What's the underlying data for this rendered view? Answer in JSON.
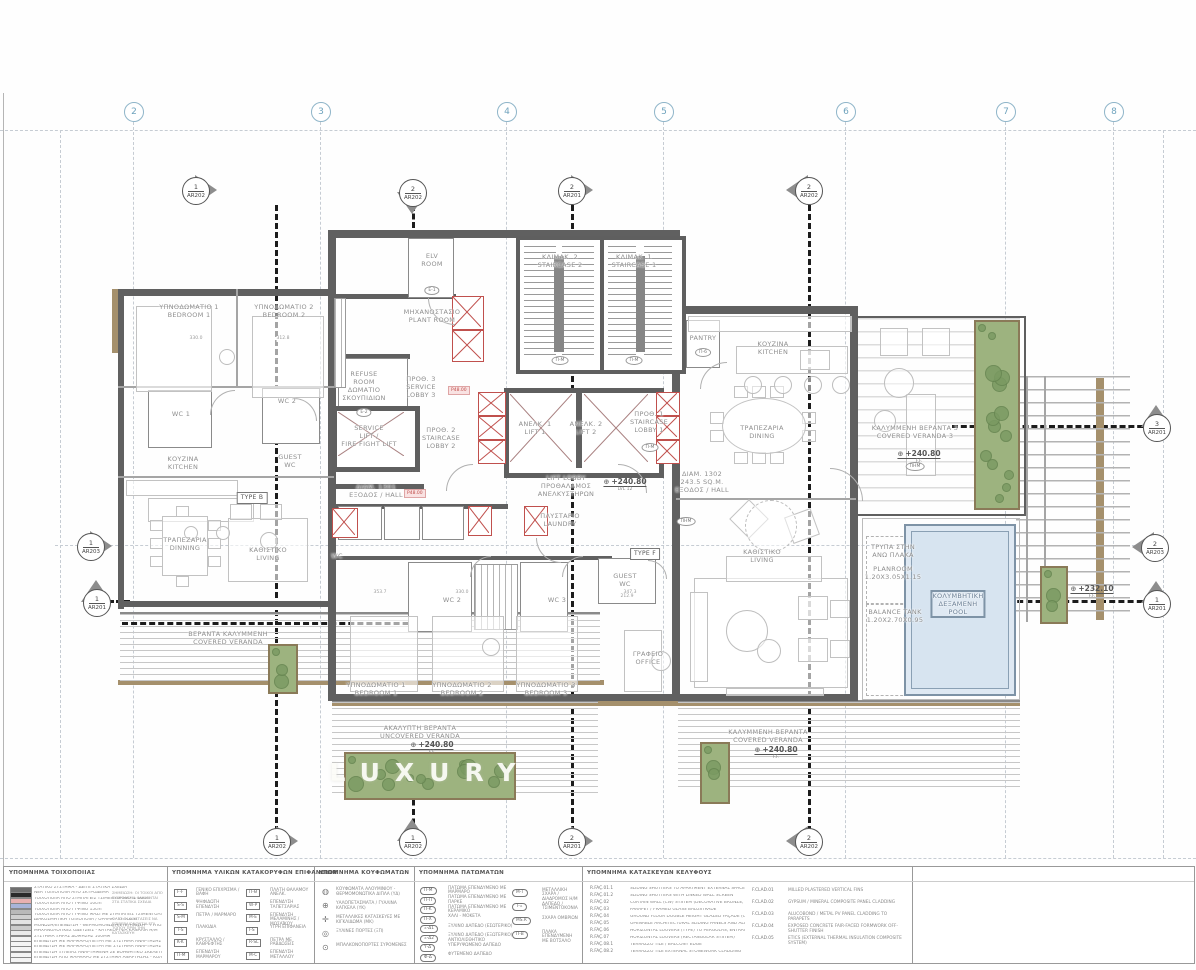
{
  "watermark": {
    "text": "LUXURY"
  },
  "grid": {
    "columns": [
      {
        "label": "2",
        "x": 133
      },
      {
        "label": "3",
        "x": 320
      },
      {
        "label": "4",
        "x": 506
      },
      {
        "label": "5",
        "x": 663
      },
      {
        "label": "6",
        "x": 845
      },
      {
        "label": "7",
        "x": 1005
      },
      {
        "label": "8",
        "x": 1113
      }
    ]
  },
  "section_markers": [
    {
      "num": "1",
      "sheet": "AR202",
      "x": 195,
      "y": 190,
      "dir": "right"
    },
    {
      "num": "2",
      "sheet": "AR202",
      "x": 412,
      "y": 192,
      "dir": "down"
    },
    {
      "num": "2",
      "sheet": "AR201",
      "x": 571,
      "y": 190,
      "dir": "right"
    },
    {
      "num": "2",
      "sheet": "AR202",
      "x": 808,
      "y": 190,
      "dir": "left"
    },
    {
      "num": "1",
      "sheet": "AR203",
      "x": 90,
      "y": 546,
      "dir": "right"
    },
    {
      "num": "1",
      "sheet": "AR201",
      "x": 96,
      "y": 602,
      "dir": "up"
    },
    {
      "num": "3",
      "sheet": "AR201",
      "x": 1156,
      "y": 427,
      "dir": "up"
    },
    {
      "num": "2",
      "sheet": "AR203",
      "x": 1154,
      "y": 547,
      "dir": "left"
    },
    {
      "num": "1",
      "sheet": "AR201",
      "x": 1156,
      "y": 603,
      "dir": "up"
    },
    {
      "num": "1",
      "sheet": "AR202",
      "x": 276,
      "y": 841,
      "dir": "right"
    },
    {
      "num": "1",
      "sheet": "AR202",
      "x": 412,
      "y": 841,
      "dir": "up"
    },
    {
      "num": "2",
      "sheet": "AR201",
      "x": 571,
      "y": 841,
      "dir": "right"
    },
    {
      "num": "2",
      "sheet": "AR202",
      "x": 808,
      "y": 841,
      "dir": "left"
    }
  ],
  "room_labels": [
    {
      "x": 189,
      "y": 303,
      "lines": [
        "ΥΠΝΟΔΩΜΑΤΙΟ 1",
        "BEDROOM 1"
      ]
    },
    {
      "x": 284,
      "y": 303,
      "lines": [
        "ΥΠΝΟΔΩΜΑΤΙΟ 2",
        "BEDROOM 2"
      ]
    },
    {
      "x": 181,
      "y": 410,
      "lines": [
        "WC 1"
      ]
    },
    {
      "x": 287,
      "y": 397,
      "lines": [
        "WC 2"
      ]
    },
    {
      "x": 183,
      "y": 455,
      "lines": [
        "ΚΟΥΖΙΝΑ",
        "KITCHEN"
      ]
    },
    {
      "x": 290,
      "y": 453,
      "lines": [
        "GUEST",
        "WC"
      ]
    },
    {
      "x": 185,
      "y": 536,
      "lines": [
        "ΤΡΑΠΕΖΑΡΙΑ",
        "DINNING"
      ]
    },
    {
      "x": 268,
      "y": 546,
      "lines": [
        "ΚΑΘΙΣΤΙΚΟ",
        "LIVING"
      ]
    },
    {
      "x": 252,
      "y": 492,
      "lines": [
        "TYPE B"
      ],
      "cls": "boxed"
    },
    {
      "x": 432,
      "y": 308,
      "lines": [
        "ΜΗΧΑΝΟΣΤΑΣΙΟ",
        "PLANT ROOM"
      ]
    },
    {
      "x": 432,
      "y": 252,
      "lines": [
        "ELV",
        "ROOM"
      ]
    },
    {
      "x": 364,
      "y": 370,
      "lines": [
        "REFUSE",
        "ROOM",
        "ΔΩΜΑΤΙΟ",
        "ΣΚΟΥΠΙΔΙΩΝ"
      ]
    },
    {
      "x": 421,
      "y": 375,
      "lines": [
        "ΠΡΟΘ. 3",
        "SERVICE",
        "LOBBY 3"
      ]
    },
    {
      "x": 369,
      "y": 424,
      "lines": [
        "SERVICE",
        "LIFT /",
        "FIRE FIGHT LIFT"
      ]
    },
    {
      "x": 441,
      "y": 426,
      "lines": [
        "ΠΡΟΘ. 2",
        "STAIRCASE",
        "LOBBY 2"
      ]
    },
    {
      "x": 535,
      "y": 420,
      "lines": [
        "ΑΝΕΛΚ. 1",
        "LIFT 1"
      ]
    },
    {
      "x": 586,
      "y": 420,
      "lines": [
        "ΑΝΕΛΚ. 2",
        "LIFT 2"
      ]
    },
    {
      "x": 560,
      "y": 253,
      "lines": [
        "ΚΛΙΜΑΚ. 2",
        "STAIRCASE 2"
      ]
    },
    {
      "x": 634,
      "y": 253,
      "lines": [
        "ΚΛΙΜΑΚ. 1",
        "STAIRCASE 1"
      ]
    },
    {
      "x": 649,
      "y": 410,
      "lines": [
        "ΠΡΟΘ. 1",
        "STAIRCASE",
        "LOBBY 1"
      ]
    },
    {
      "x": 566,
      "y": 474,
      "lines": [
        "LIFT LOBBY",
        "ΠΡΟΘΑΛΑΜΟΣ",
        "ΑΝΕΛΚΥΣΤΗΡΩΝ"
      ]
    },
    {
      "x": 376,
      "y": 483,
      "lines": [
        "ΔΙΑΜ. 1301",
        "ΕΞΟΔΟΣ / HALL"
      ]
    },
    {
      "x": 702,
      "y": 470,
      "lines": [
        "ΔΙΑΜ. 1302",
        "243.5 SQ.M.",
        "ΕΞΟΔΟΣ / HALL"
      ]
    },
    {
      "x": 560,
      "y": 512,
      "lines": [
        "ΠΛΥΣΤΑΡΙΟ",
        "LAUNDRY"
      ]
    },
    {
      "x": 703,
      "y": 334,
      "lines": [
        "PANTRY"
      ]
    },
    {
      "x": 773,
      "y": 340,
      "lines": [
        "ΚΟΥΖΙΝΑ",
        "KITCHEN"
      ]
    },
    {
      "x": 762,
      "y": 424,
      "lines": [
        "ΤΡΑΠΕΖΑΡΙΑ",
        "DINING"
      ]
    },
    {
      "x": 915,
      "y": 424,
      "lines": [
        "ΚΑΛΥΜΜΕΝΗ ΒΕΡΑΝΤΑ 3",
        "COVERED VERANDA 3"
      ]
    },
    {
      "x": 762,
      "y": 548,
      "lines": [
        "ΚΑΘΙΣΤΙΚΟ",
        "LIVING"
      ]
    },
    {
      "x": 893,
      "y": 543,
      "lines": [
        "ΤΡΥΠΑ ΣΤΗΝ",
        "ΑΝΩ ΠΛΑΚΑ"
      ]
    },
    {
      "x": 893,
      "y": 565,
      "lines": [
        "PLANROOM",
        "1.20X3.05X1.15"
      ]
    },
    {
      "x": 895,
      "y": 608,
      "lines": [
        "BALANCE TANK",
        "1.20X2.70X0.95"
      ]
    },
    {
      "x": 958,
      "y": 590,
      "lines": [
        "ΚΟΛΥΜΒΗΤΙΚΗ",
        "ΔΕΞΑΜΕΝΗ",
        "POOL"
      ],
      "cls": "pool"
    },
    {
      "x": 337,
      "y": 552,
      "lines": [
        "WC"
      ]
    },
    {
      "x": 452,
      "y": 596,
      "lines": [
        "WC 2"
      ]
    },
    {
      "x": 557,
      "y": 596,
      "lines": [
        "WC 3"
      ]
    },
    {
      "x": 625,
      "y": 572,
      "lines": [
        "GUEST",
        "WC"
      ]
    },
    {
      "x": 648,
      "y": 650,
      "lines": [
        "ΓΡΑΦΕΙΟ",
        "OFFICE"
      ]
    },
    {
      "x": 645,
      "y": 548,
      "lines": [
        "TYPE F"
      ],
      "cls": "boxed"
    },
    {
      "x": 376,
      "y": 681,
      "lines": [
        "ΥΠΝΟΔΩΜΑΤΙΟ 1",
        "BEDROOM 1"
      ]
    },
    {
      "x": 462,
      "y": 681,
      "lines": [
        "ΥΠΝΟΔΩΜΑΤΙΟ 2",
        "BEDROOM 2"
      ]
    },
    {
      "x": 546,
      "y": 681,
      "lines": [
        "ΥΠΝΟΔΩΜΑΤΙΟ 3",
        "BEDROOM 3"
      ]
    },
    {
      "x": 228,
      "y": 630,
      "lines": [
        "ΒΕΡΑΝΤΑ ΚΑΛΥΜΜΕΝΗ",
        "COVERED VERANDA"
      ]
    },
    {
      "x": 420,
      "y": 724,
      "lines": [
        "ΑΚΑΛΥΠΤΗ ΒΕΡΑΝΤΑ",
        "UNCOVERED VERANDA"
      ]
    },
    {
      "x": 768,
      "y": 728,
      "lines": [
        "ΚΑΛΥΜΜΕΝΗ ΒΕΡΑΝΤΑ",
        "COVERED VERANDA"
      ]
    }
  ],
  "oval_tags": [
    {
      "text": "Ε-1",
      "x": 432,
      "y": 286
    },
    {
      "text": "Ε-2",
      "x": 364,
      "y": 408
    },
    {
      "text": "Π-Μ",
      "x": 560,
      "y": 356
    },
    {
      "text": "Π-Μ",
      "x": 634,
      "y": 356
    },
    {
      "text": "Π-Μ",
      "x": 650,
      "y": 443
    },
    {
      "text": "Π-6",
      "x": 703,
      "y": 348
    },
    {
      "text": "ΠΗΜ",
      "x": 915,
      "y": 462
    },
    {
      "text": "ΠΗΜ",
      "x": 686,
      "y": 517
    }
  ],
  "chips": [
    {
      "text": "Ρ48.00",
      "x": 448,
      "y": 386
    },
    {
      "text": "Ρ48.00",
      "x": 404,
      "y": 489
    }
  ],
  "elevations": [
    {
      "value": "+240.80",
      "sub": "LVL 12",
      "x": 625,
      "y": 477
    },
    {
      "value": "+240.80",
      "sub": "F.F.",
      "x": 919,
      "y": 449
    },
    {
      "value": "+240.80",
      "sub": "F.F.",
      "x": 432,
      "y": 740
    },
    {
      "value": "+240.80",
      "sub": "F.F.",
      "x": 776,
      "y": 745
    },
    {
      "value": "+232.10",
      "sub": "F.F.",
      "x": 1092,
      "y": 584
    }
  ],
  "dims": [
    {
      "text": "330.0",
      "x": 196,
      "y": 336
    },
    {
      "text": "312.8",
      "x": 283,
      "y": 336
    },
    {
      "text": "353.7",
      "x": 380,
      "y": 590
    },
    {
      "text": "330.0",
      "x": 462,
      "y": 590
    },
    {
      "text": "347.3",
      "x": 630,
      "y": 590
    },
    {
      "text": "212.9",
      "x": 627,
      "y": 594
    }
  ],
  "legend": {
    "col1": {
      "title": "ΥΠΟΜΝΗΜΑ ΤΟΙΧΟΠΟΙΙΑΣ",
      "rows": [
        {
          "c": "#6f6f6f",
          "t": "ΣΤΑΤΙΚΟ ΣΥΣΤΗΜΑ - ΔΕΙΤΕ ΣΤΑΤΙΚΑ ΣΧΕΔΙΑ"
        },
        {
          "c": "#2a2a2a",
          "t": "ΝΕΑ ΤΟΙΧΟΠΟΙΙΑ ΑΠΟ ΣΚΥΡΟΔΕΜΑ"
        },
        {
          "c": "#e8b0b0",
          "t": "ΤΟΙΧΟΠΟΙΙΑ ΑΠΟ ΣΥΜΠΑΓΕΙΣ ΤΣΙΜΕΝΤΟΛΙΘΟΥΣ 10cm"
        },
        {
          "c": "#a8b4d8",
          "t": "ΤΟΙΧΟΠΟΙΙΑ ΑΠΟ ΓΥΨΙΝΟ 10cm"
        },
        {
          "c": "#b9b9b9",
          "t": "ΤΟΙΧΟΠΟΙΙΑ ΑΠΟ ΓΥΨΙΝΟ 15cm"
        },
        {
          "c": "#d0d0d0",
          "t": "ΤΟΙΧΟΠΟΙΙΑ ΑΠΟ ΓΥΨΙΝΟ ΜΑΖΙ ΜΕ ΣΥΜΠΑΓΕΙΣ ΤΣΙΜΕΝΤΟΛΙΘΟΥΣ"
        },
        {
          "c": "#e3e3e3",
          "t": "ΔΙΑΚΟΣΜΗΤΙΚΗ ΤΟΙΧΟΠΟΙΙΑ / ΟΡΑΜΑ - ΤΥΠΟΣ Β"
        },
        {
          "c": "#cccccc",
          "t": "ΜΟΝΩΣΗ/ΕΠΕΝΔΥΣΗ - ΘΕΡΜΟΜΟΝΩΣΗ/ΣΤΕΓΑΝΩΣΗ - ΤΥΠΟΣ 1"
        },
        {
          "c": "#e9e9e9",
          "t": "ΜΗΧΑΝΟΛΟΓΙΚΕΣ ΟΔΕΥΣΕΙΣ - ΚΑΤΑΚΟΡΥΦΑ ΚΑΝΑΛΙΑ Η/Μ"
        },
        {
          "c": "#f2f2f2",
          "t": "ΣΥΣΤΗΜΑ ΞΗΡΑΣ ΔΟΜΗΣΗΣ 100MM"
        },
        {
          "c": "#f4f4f4",
          "t": "ΕΠΕΝΔΥΣΗ ΜΕ ΜΑΡΜΑΡΟ/ΠΕΤΡΑ ΜΕ ΣΥΣΤΗΜΑ ΑΝΑΡΤΗΣΗΣ - ΚΟΛΛΑ"
        },
        {
          "c": "#f4f4f4",
          "t": "ΕΠΕΝΔΥΣΗ ΜΕ ΜΑΡΜΑΡΟ/ΠΕΤΡΑ ΜΕ ΣΥΣΤΗΜΑ ΑΝΑΡΤΗΣΗΣ ΧΩΡΙΣ ΚΟΛΛΑ"
        },
        {
          "c": "#f4f4f4",
          "t": "ΕΠΕΝΔΥΣΗ ΞΥΛΕΙΑΣ ΑΝΑΡΤΗΜΕΝΗ ΣΕ ΒΟΗΘΗΤΙΚΟ ΣΚΕΛΕΤΟ"
        },
        {
          "c": "#f4f4f4",
          "t": "ΕΠΕΝΔΥΣΗ ΑΠΟ ΜΑΡΜΑΡΟ ΜΕ ΣΥΣΤΗΜΑ ΑΝΑΡΤΗΣΗΣ - ΚΟΛΛΑ"
        }
      ],
      "notes": [
        "ΣΗΜΕΙΩΣΗ: ΟΙ ΤΟΙΧΟΙ ΑΠΟ ΣΚΥΡΟΔΕΜΑ ΦΑΙΝΟΝΤΑΙ ΣΤΑ ΣΤΑΤΙΚΑ ΣΧΕΔΙΑ",
        "ΟΛΕΣ ΟΙ ΔΙΑΣΤΑΣΕΙΣ ΝΑ ΕΠΙΒΕΒΑΙΩΝΟΝΤΑΙ ΕΠΙ ΤΟΠΟΥ ΠΡΙΝ ΤΗΝ ΚΑΤΑΣΚΕΥΗ"
      ]
    },
    "col2": {
      "title": "ΥΠΟΜΝΗΜΑ ΥΛΙΚΩΝ ΚΑΤΑΚΟΡΥΦΩΝ ΕΠΙΦΑΝΕΙΩΝ",
      "left": [
        {
          "code": "F-F",
          "t": "ΓΕΝΙΚΟ ΕΠΙΧΡΙΣΜΑ / ΒΑΦΗ"
        },
        {
          "code": "S-S",
          "t": "ΨΗΦΙΔΩΤΗ ΕΠΕΝΔΥΣΗ"
        },
        {
          "code": "S-M",
          "t": "ΠΕΤΡΑ / ΜΑΡΜΑΡΟ"
        },
        {
          "code": "T-S",
          "t": "ΠΛΑΚΙΔΙΑ"
        },
        {
          "code": "K-K",
          "t": "ΚΡΥΣΤΑΛΛΟ / ΚΑΘΡΕΦΤΗΣ"
        },
        {
          "code": "Π-Μ",
          "t": "ΕΠΕΝΔΥΣΗ ΜΑΡΜΑΡΟΥ"
        }
      ],
      "right": [
        {
          "code": "Π-Θ",
          "t": "ΠΛΑΤΗ ΘΑΛΑΜΟΥ ΑΝΕΛΚ."
        },
        {
          "code": "W-P",
          "t": "ΕΠΕΝΔΥΣΗ ΤΑΠΕΤΣΑΡΙΑΣ"
        },
        {
          "code": "M-E",
          "t": "ΕΠΕΝΔΥΣΗ ΜΕΛΑΜΙΝΗΣ / ΜΩΣΑΪΚΟΥ"
        },
        {
          "code": "I-S",
          "t": "ΥΓΡΗ ΕΠΙΦΑΝΕΙΑ"
        },
        {
          "code": "R-SL",
          "t": "ΠΕΤΡΑ ΜΕ ΡΑΒΔΩΣΕΙΣ"
        },
        {
          "code": "M-C",
          "t": "ΕΠΕΝΔΥΣΗ ΜΕΤΑΛΛΟΥ"
        }
      ]
    },
    "col3": {
      "title": "ΥΠΟΜΝΗΜΑ ΚΟΥΦΩΜΑΤΩΝ",
      "items": [
        {
          "sym": "◍",
          "t": "ΚΟΥΦΩΜΑΤΑ ΑΛΟΥΜΙΝΙΟΥ - ΘΕΡΜΟΜΟΝΩΤΙΚΑ ΔΙΠΛΑ (ΥΔ)"
        },
        {
          "sym": "⊕",
          "t": "ΥΑΛΟΠΕΤΑΣΜΑΤΑ / ΓΥΑΛΙΝΑ ΚΑΓΚΕΛΑ (ΥΚ)"
        },
        {
          "sym": "✛",
          "t": "ΜΕΤΑΛΛΙΚΕΣ ΚΑΤΑΣΚΕΥΕΣ ΜΕ ΚΙΓΚΛΙΔΩΜΑ (ΜΚ)"
        },
        {
          "sym": "◎",
          "t": "ΞΥΛΙΝΕΣ ΠΟΡΤΕΣ (ΞΠ)"
        },
        {
          "sym": "⊙",
          "t": "ΜΠΑΛΚΟΝΟΠΟΡΤΕΣ ΣΥΡΟΜΕΝΕΣ"
        }
      ]
    },
    "col4": {
      "title": "ΥΠΟΜΝΗΜΑ ΠΑΤΩΜΑΤΩΝ",
      "left": [
        {
          "code": "Π-Μ",
          "t": "ΠΑΤΩΜΑ ΕΠΕΝΔΥΜΕΝΟ ΜΕ ΜΑΡΜΑΡΟ"
        },
        {
          "code": "Π-Π",
          "t": "ΠΑΤΩΜΑ ΕΠΕΝΔΥΜΕΝΟ ΜΕ ΠΑΡΚΕ"
        },
        {
          "code": "Π-Κ",
          "t": "ΠΑΤΩΜΑ ΕΠΕΝΔΥΜΕΝΟ ΜΕ ΚΕΡΑΜΙΚΟ"
        },
        {
          "code": "Π-Χ",
          "t": "ΧΑΛΙ - ΜΟΚΕΤΑ"
        },
        {
          "code": "Ξ-Δ1",
          "t": "ΞΥΛΙΝΟ ΔΑΠΕΔΟ (ΕΣΩΤΕΡΙΚΟ)"
        },
        {
          "code": "Ξ-Δ2",
          "t": "ΞΥΛΙΝΟ ΔΑΠΕΔΟ (ΕΞΩΤΕΡΙΚΟ) ΑΝΤΙΟΛΙΣΘΗΤΙΚΟ"
        },
        {
          "code": "Υ-Δ",
          "t": "ΥΠΕΡΥΨΩΜΕΝΟ ΔΑΠΕΔΟ"
        },
        {
          "code": "Φ-Δ",
          "t": "ΦΥΤΕΜΕΝΟ ΔΑΠΕΔΟ"
        }
      ],
      "right": [
        {
          "code": "M-T",
          "t": "ΜΕΤΑΛΛΙΚΗ ΣΧΑΡΑ / ΔΙΑΔΡΟΜΟΣ Η/Μ"
        },
        {
          "code": "T-Ξ",
          "t": "ΔΑΠΕΔΟ / ΤΣΙΜΕΝΤΟΚΟΝΙΑ"
        },
        {
          "code": "MS.R",
          "t": "ΣΧΑΡΑ ΟΜΒΡΙΩΝ"
        },
        {
          "code": "Π-Β",
          "t": "ΠΛΑΚΑ ΕΠΕΝΔΥΜΕΝΗ ΜΕ ΒΟΤΣΑΛΟ"
        }
      ]
    },
    "col5": {
      "title": "ΥΠΟΜΝΗΜΑ ΚΑΤΑΣΚΕΥΩΝ ΚΕΛΥΦΟΥΣ",
      "left": [
        {
          "code": "R.FAÇ.01.1",
          "t": "SLIDING SHUTTERS TO APARTMENT EXTERNAL SPACES"
        },
        {
          "code": "R.FAÇ.01.2",
          "t": "SLIDING SHUTTERS WITH LINKED WALL SCREEN"
        },
        {
          "code": "R.FAÇ.02",
          "t": "CURTAIN WALL (CW) SYSTEM (DECORATIVE BRONZE, SCREEN, HORIZONTAL & VERTICAL ELEMENTS, ALUMINIUM LOUVRES)"
        },
        {
          "code": "R.FAÇ.03",
          "t": "PARAPET / FRAMED GLASS BALUSTRADE"
        },
        {
          "code": "R.FAÇ.04",
          "t": "GROUND FLOOR DOUBLE HEIGHT GLAZED FAÇADE (CW SYSTEM)"
        },
        {
          "code": "R.FAÇ.05",
          "t": "OPENABLE ARCHITECTURAL SLIDING PANELS AND ALUMINIUM DOORS IN ANODIZED FINISH"
        },
        {
          "code": "R.FAÇ.06",
          "t": "HORIZONTAL LOUVERS (TYPE) TO PERGOLAS, ENTRANCE CANOPIES AND EXTERNAL SPACES"
        },
        {
          "code": "R.FAÇ.07",
          "t": "HORIZONTAL LOUVERS (RECTANGULAR SYSTEM)"
        },
        {
          "code": "R.FAÇ.08.1",
          "t": "TERRAZZO TILE / BALCONY EDGE"
        },
        {
          "code": "R.FAÇ.08.2",
          "t": "TERRAZZO TILE EXTERNAL STONEWORK CLADDING"
        }
      ],
      "right": [
        {
          "code": "F.CLAD.01",
          "t": "MILLED PLASTERED VERTICAL FINS"
        },
        {
          "code": "F.CLAD.02",
          "t": "GYPSUM / MINERAL COMPOSITE PANEL CLADDING"
        },
        {
          "code": "F.CLAD.03",
          "t": "ALUCOBOND / METAL PV PANEL CLADDING TO PARAPETS"
        },
        {
          "code": "F.CLAD.04",
          "t": "EXPOSED CONCRETE FAIR-FACED FORMWORK OFF-SHUTTER FINISH"
        },
        {
          "code": "F.CLAD.05",
          "t": "ETICS (EXTERNAL THERMAL INSULATION COMPOSITE SYSTEM)"
        }
      ]
    }
  }
}
